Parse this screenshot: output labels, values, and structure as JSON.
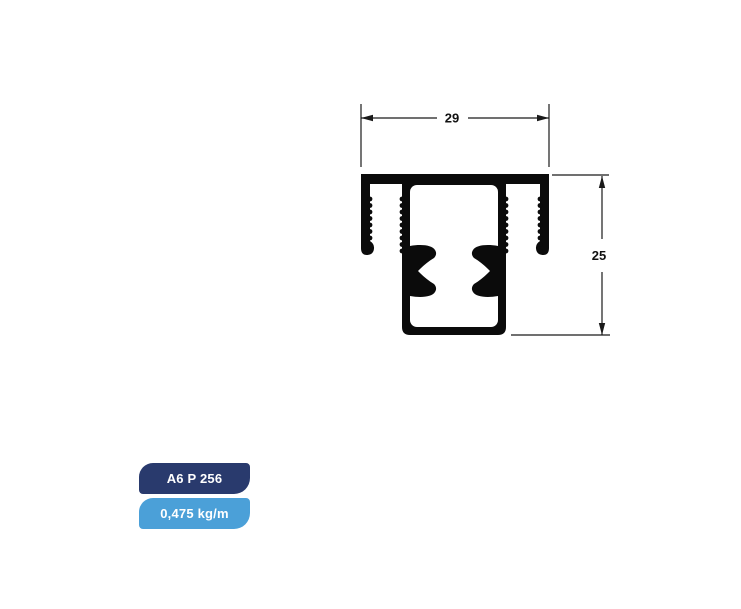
{
  "page": {
    "background": "#ffffff"
  },
  "drawing": {
    "title": "aluminium-profile-cross-section",
    "profile_color": "#0b0b0b",
    "line_color": "#1a1a1a",
    "dimensions": {
      "width": {
        "value": "29"
      },
      "height": {
        "value": "25"
      }
    }
  },
  "badges": {
    "code": {
      "label": "A6 P 256",
      "bg": "#293a6d",
      "text_color": "#ffffff"
    },
    "weight": {
      "label": "0,475 kg/m",
      "bg": "#4ba0d8",
      "text_color": "#ffffff"
    }
  }
}
